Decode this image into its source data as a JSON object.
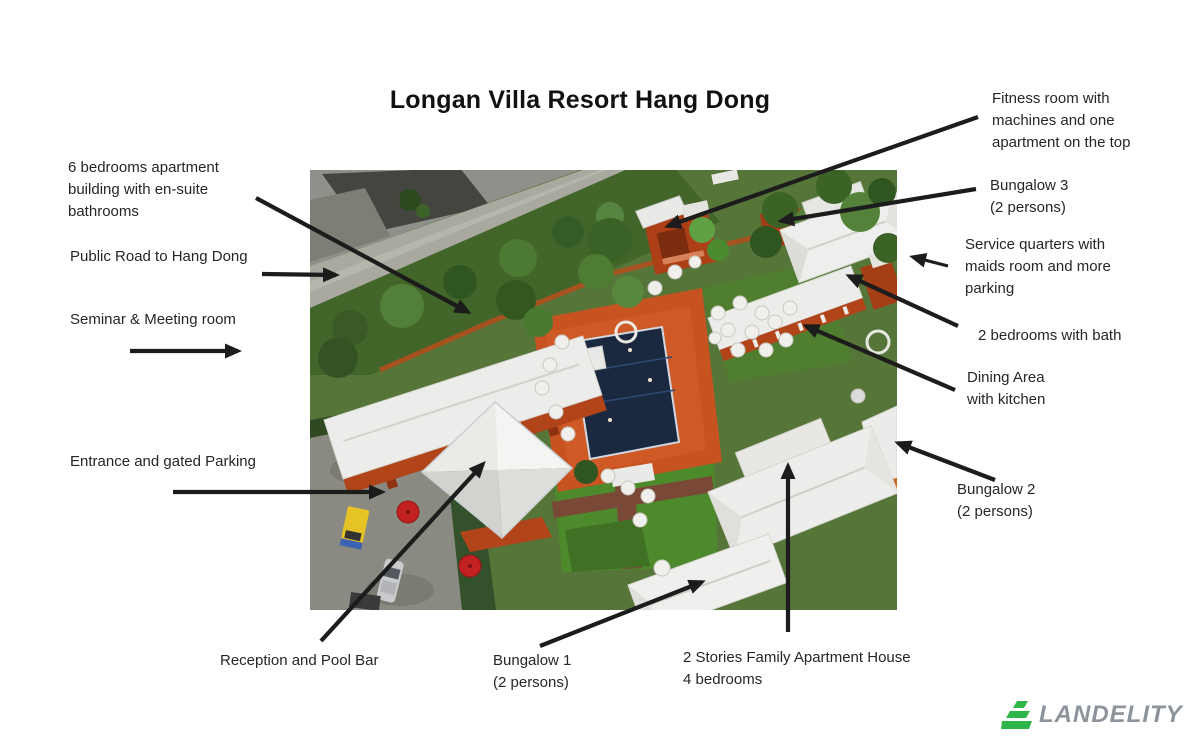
{
  "title": "Longan Villa Resort Hang Dong",
  "annotations": {
    "six_bedrooms": {
      "text": "6 bedrooms apartment\nbuilding  with en-suite\nbathrooms"
    },
    "public_road": {
      "text": "Public Road to Hang Dong"
    },
    "seminar": {
      "text": "Seminar & Meeting room"
    },
    "entrance": {
      "text": "Entrance and gated Parking"
    },
    "fitness": {
      "text": "Fitness room with\nmachines and one\napartment on the top"
    },
    "bungalow3": {
      "text": "Bungalow 3\n(2 persons)"
    },
    "service_quarters": {
      "text": "Service quarters with\nmaids room and more\nparking"
    },
    "two_bedrooms": {
      "text": "2 bedrooms with bath"
    },
    "dining": {
      "text": "Dining Area\nwith kitchen"
    },
    "bungalow2": {
      "text": "Bungalow 2\n(2 persons)"
    },
    "reception": {
      "text": "Reception and Pool Bar"
    },
    "bungalow1": {
      "text": "Bungalow 1\n(2 persons)"
    },
    "family_apartment": {
      "text": "2 Stories Family Apartment  House\n4 bedrooms"
    }
  },
  "logo": {
    "text": "LANDELITY",
    "icon": "terraced-land-icon",
    "icon_color": "#2fb64b",
    "text_color": "#8d939b"
  },
  "photo": {
    "description": "Aerial drone photo of Longan Villa Resort Hang Dong",
    "features": [
      "public road",
      "neighbor house",
      "6 bedrooms apartment / seminar building",
      "fitness building",
      "bungalow 3 in trees",
      "dining area with kitchen",
      "service quarters",
      "2 bedroom villa",
      "swimming pool",
      "pool bar",
      "reception pyramid roof",
      "bungalow 1",
      "bungalow 2",
      "2 stories family apartment house",
      "gated parking",
      "yellow truck",
      "silver car",
      "red umbrellas",
      "white umbrellas",
      "lawn with paths"
    ],
    "colors": {
      "roof_white": "#ececea",
      "building_orange": "#b2441a",
      "pool_navy": "#1b2940",
      "lawn_green": "#4e8a2f",
      "tree_green": "#3c6326",
      "road_gray": "#a9a9a0",
      "parking_gray": "#8b8a82",
      "arrow_black": "#1c1c1c"
    }
  }
}
